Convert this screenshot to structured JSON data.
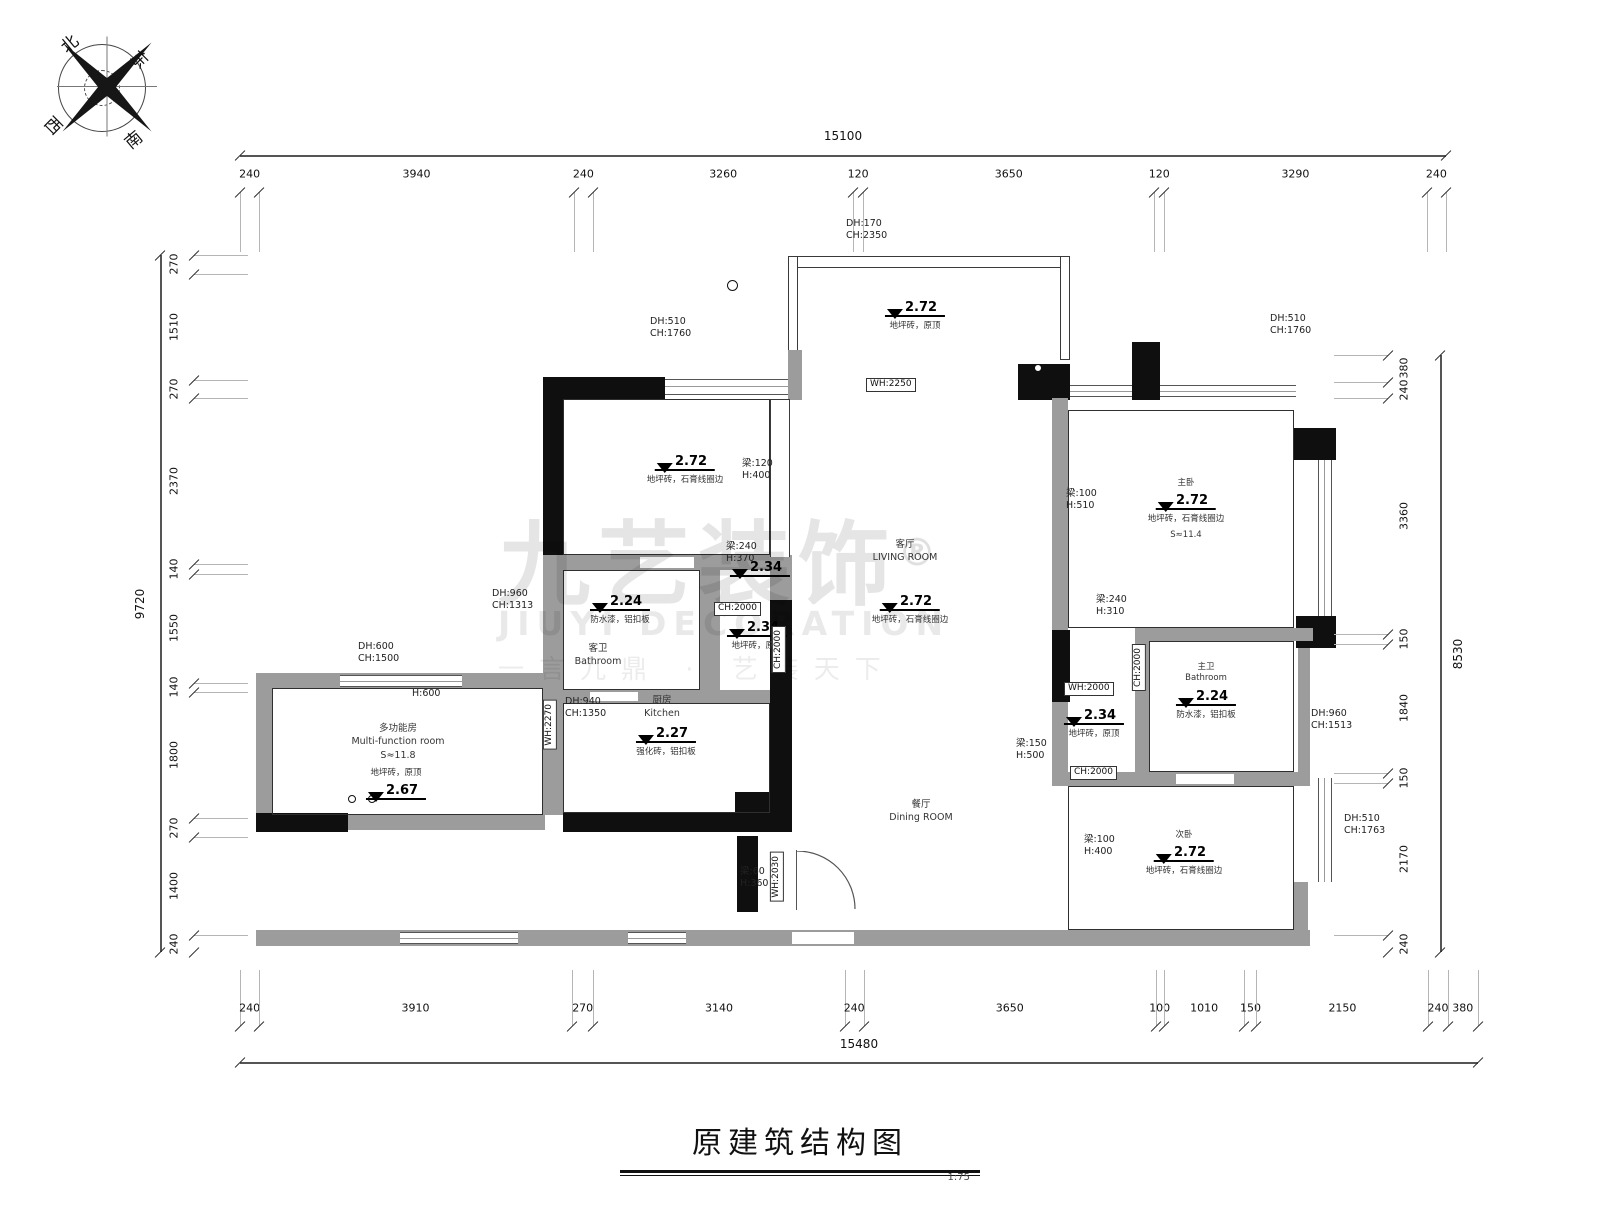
{
  "meta": {
    "title": "原建筑结构图",
    "scale": "1:75"
  },
  "compass": {
    "labels": [
      "北",
      "东",
      "西",
      "南"
    ]
  },
  "watermark": {
    "brand": "九艺装饰",
    "reg": "®",
    "en": "JIUYI DECORATION",
    "slogan": "一言九鼎 · 艺装天下"
  },
  "colors": {
    "wall_black": "#0f0f0f",
    "wall_gray": "#9c9c9c",
    "line": "#555555"
  },
  "dim_chains": [
    {
      "orient": "h",
      "total": "15100",
      "x0": 240,
      "x1": 1446,
      "line": 155,
      "total_pos": 136,
      "labels": 174,
      "ticks": 192,
      "ext": 60,
      "segments": [
        "240",
        "3940",
        "240",
        "3260",
        "120",
        "3650",
        "120",
        "3290",
        "240"
      ]
    },
    {
      "orient": "h",
      "total": "15480",
      "x0": 240,
      "x1": 1478,
      "line": 1062,
      "total_pos": 1044,
      "labels": 1008,
      "ticks": 1026,
      "ext": -56,
      "segments": [
        "240",
        "3910",
        "270",
        "3140",
        "240",
        "3650",
        "100",
        "1010",
        "150",
        "2150",
        "240",
        "380"
      ]
    },
    {
      "orient": "v",
      "total": "9720",
      "y0": 255,
      "y1": 952,
      "line": 160,
      "total_pos": 140,
      "labels": 174,
      "ticks": 194,
      "ext": 54,
      "segments": [
        "270",
        "1510",
        "270",
        "2370",
        "140",
        "1550",
        "140",
        "1800",
        "270",
        "1400",
        "240"
      ]
    },
    {
      "orient": "v",
      "total": "8530",
      "y0": 355,
      "y1": 952,
      "line": 1440,
      "total_pos": 1458,
      "labels": 1404,
      "ticks": 1388,
      "ext": -54,
      "segments": [
        "380",
        "240",
        "3360",
        "150",
        "1840",
        "150",
        "2170",
        "240"
      ]
    }
  ],
  "levels": [
    {
      "value": "2.72",
      "x": 915,
      "y": 296,
      "above": [],
      "below": [
        "地坪砖，原顶"
      ]
    },
    {
      "value": "2.72",
      "x": 685,
      "y": 450,
      "above": [],
      "below": [
        "地坪砖，石膏线圈边"
      ]
    },
    {
      "value": "2.24",
      "x": 620,
      "y": 590,
      "above": [],
      "below": [
        "防水漆，铝扣板"
      ]
    },
    {
      "value": "2.34",
      "x": 760,
      "y": 556,
      "above": [],
      "below": []
    },
    {
      "value": "2.34",
      "x": 757,
      "y": 616,
      "above": [],
      "below": [
        "地坪砖，原顶"
      ]
    },
    {
      "value": "2.72",
      "x": 910,
      "y": 590,
      "above": [],
      "below": [
        "地坪砖，石膏线圈边"
      ]
    },
    {
      "value": "2.27",
      "x": 666,
      "y": 722,
      "above": [],
      "below": [
        "强化砖，铝扣板"
      ]
    },
    {
      "value": "2.67",
      "x": 396,
      "y": 768,
      "above": [
        "地坪砖，原顶"
      ],
      "below": []
    },
    {
      "value": "2.72",
      "x": 1186,
      "y": 478,
      "above": [
        "主卧"
      ],
      "below": [
        "地坪砖，石膏线圈边",
        "S≈11.4"
      ]
    },
    {
      "value": "2.34",
      "x": 1094,
      "y": 704,
      "above": [],
      "below": [
        "地坪砖，原顶"
      ]
    },
    {
      "value": "2.24",
      "x": 1206,
      "y": 662,
      "above": [
        "主卫",
        "Bathroom"
      ],
      "below": [
        "防水漆，铝扣板"
      ]
    },
    {
      "value": "2.72",
      "x": 1184,
      "y": 830,
      "above": [
        "次卧"
      ],
      "below": [
        "地坪砖，石膏线圈边"
      ]
    }
  ],
  "rooms": [
    {
      "lines": [
        "客厅",
        "LIVING ROOM"
      ],
      "x": 905,
      "y": 538
    },
    {
      "lines": [
        "餐厅",
        "Dining ROOM"
      ],
      "x": 921,
      "y": 798
    },
    {
      "lines": [
        "客卫",
        "Bathroom"
      ],
      "x": 598,
      "y": 642
    },
    {
      "lines": [
        "厨房",
        "Kitchen"
      ],
      "x": 662,
      "y": 694
    },
    {
      "lines": [
        "多功能房",
        "Multi-function room",
        "S≈11.8"
      ],
      "x": 398,
      "y": 722
    }
  ],
  "notes": [
    {
      "lines": [
        "DH:170",
        "CH:2350"
      ],
      "x": 846,
      "y": 218
    },
    {
      "lines": [
        "DH:510",
        "CH:1760"
      ],
      "x": 650,
      "y": 316
    },
    {
      "lines": [
        "DH:510",
        "CH:1760"
      ],
      "x": 1270,
      "y": 313
    },
    {
      "lines": [
        "梁:120",
        "H:400"
      ],
      "x": 742,
      "y": 458
    },
    {
      "lines": [
        "梁:240",
        "H:370"
      ],
      "x": 726,
      "y": 541
    },
    {
      "lines": [
        "DH:960",
        "CH:1313"
      ],
      "x": 492,
      "y": 588
    },
    {
      "lines": [
        "DH:600",
        "CH:1500"
      ],
      "x": 358,
      "y": 641
    },
    {
      "lines": [
        "H:600"
      ],
      "x": 412,
      "y": 688
    },
    {
      "lines": [
        "DH:940",
        "CH:1350"
      ],
      "x": 565,
      "y": 696
    },
    {
      "lines": [
        "梁:100",
        "H:510"
      ],
      "x": 1066,
      "y": 488
    },
    {
      "lines": [
        "梁:240",
        "H:310"
      ],
      "x": 1096,
      "y": 594
    },
    {
      "lines": [
        "梁:150",
        "H:500"
      ],
      "x": 1016,
      "y": 738
    },
    {
      "lines": [
        "DH:960",
        "CH:1513"
      ],
      "x": 1311,
      "y": 708
    },
    {
      "lines": [
        "梁:100",
        "H:400"
      ],
      "x": 1084,
      "y": 834
    },
    {
      "lines": [
        "DH:510",
        "CH:1763"
      ],
      "x": 1344,
      "y": 813
    },
    {
      "lines": [
        "梁:60",
        "H:360"
      ],
      "x": 740,
      "y": 866
    }
  ],
  "boxed": [
    {
      "t": "WH:2250",
      "x": 866,
      "y": 378,
      "vert": false
    },
    {
      "t": "CH:2000",
      "x": 714,
      "y": 602,
      "vert": false
    },
    {
      "t": "CH:2000",
      "x": 772,
      "y": 626,
      "vert": true
    },
    {
      "t": "WH:2270",
      "x": 543,
      "y": 700,
      "vert": true
    },
    {
      "t": "WH:2030",
      "x": 770,
      "y": 852,
      "vert": true
    },
    {
      "t": "WH:2000",
      "x": 1064,
      "y": 682,
      "vert": false
    },
    {
      "t": "CH:2000",
      "x": 1132,
      "y": 644,
      "vert": true
    },
    {
      "t": "CH:2000",
      "x": 1070,
      "y": 766,
      "vert": false
    }
  ],
  "circles": [
    {
      "x": 348,
      "y": 795,
      "d": 8
    },
    {
      "x": 368,
      "y": 795,
      "d": 8
    },
    {
      "x": 727,
      "y": 280,
      "d": 11
    },
    {
      "x": 1034,
      "y": 364,
      "d": 8
    }
  ]
}
